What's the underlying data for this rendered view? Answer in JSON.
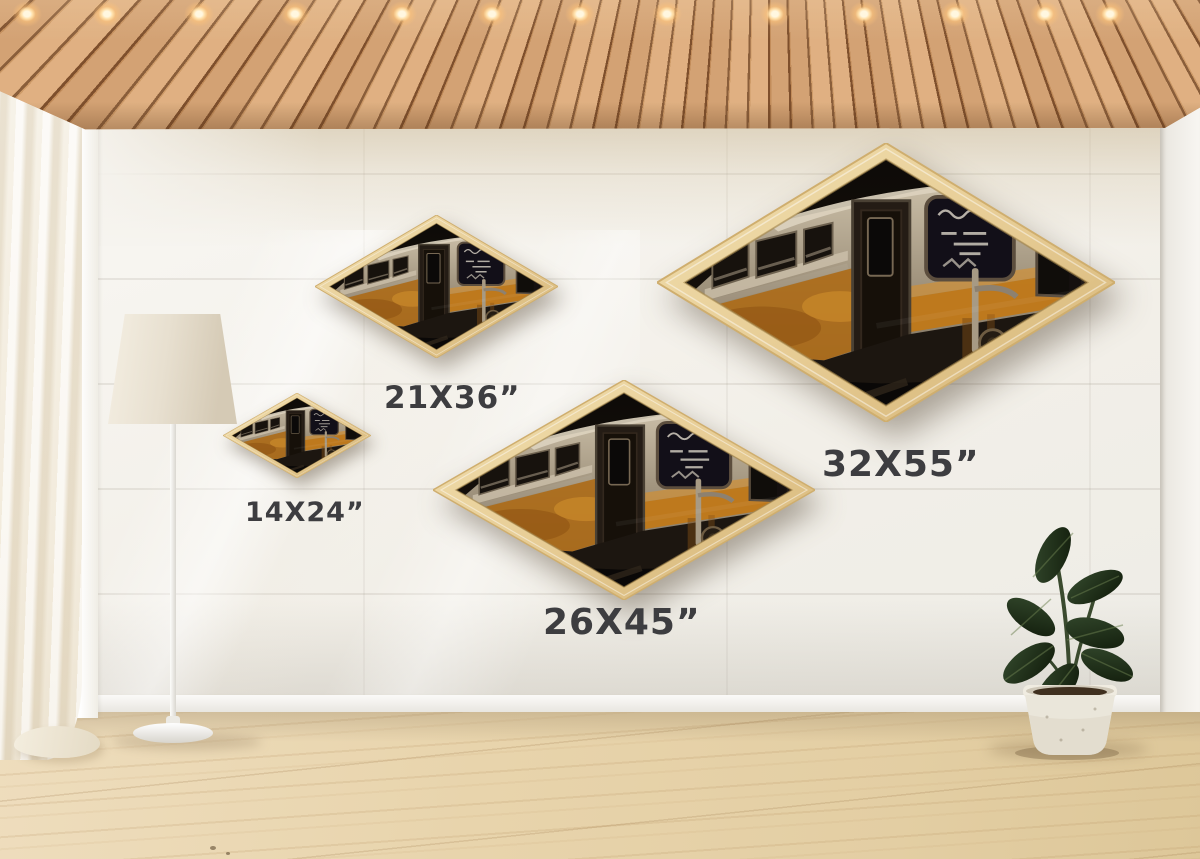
{
  "scene": {
    "name": "diamond-canvas-wall-mockup",
    "room": "interior with wood slat ceiling, white plank wall, sheer curtain, floor lamp, potted plant and wood floor"
  },
  "artwork": {
    "name": "graffiti-subway-train-print",
    "shape": "diamond",
    "frame_color": "#e8cf9a"
  },
  "sizes": [
    {
      "id": "14x24",
      "label": "14X24”"
    },
    {
      "id": "21x36",
      "label": "21X36”"
    },
    {
      "id": "26x45",
      "label": "26X45”"
    },
    {
      "id": "32x55",
      "label": "32X55”"
    }
  ],
  "colors": {
    "label_text": "#3d3d40",
    "frame_wood": "#e8cf9a",
    "ceiling_wood": "#cf9c6a",
    "ceiling_gap": "#7d4f2c",
    "wall": "#f3f0ea",
    "wall_top_band": "#d9cbab",
    "side_wall": "#f2efe9",
    "floor": "#e8d4ac",
    "curtain": "#f4eedf",
    "lamp_shade": "#e9e2d3",
    "pot": "#eae6da",
    "leaf_green": "#22301d",
    "art_orange": "#c07818",
    "art_dark": "#14100c",
    "art_silver": "#a2957f",
    "light_glow": "#ffdfa8"
  }
}
